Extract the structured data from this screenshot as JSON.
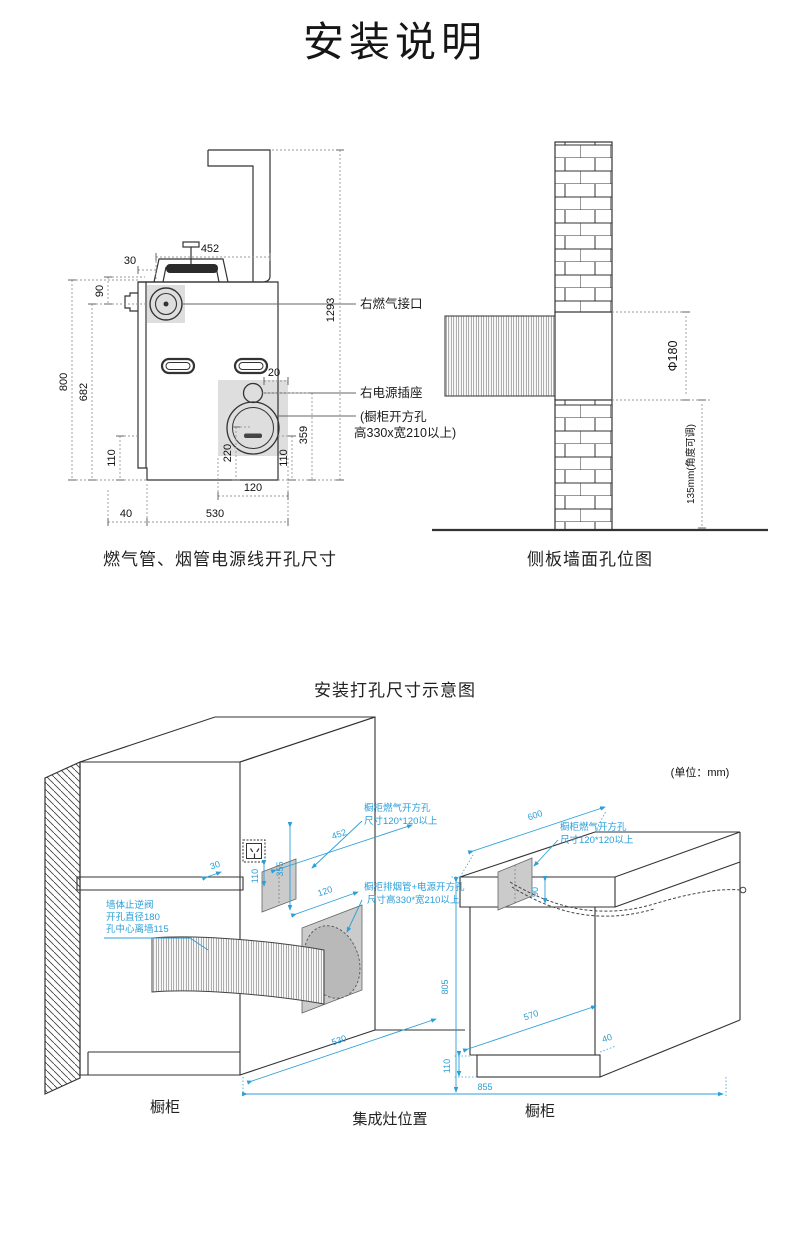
{
  "page": {
    "title": "安装说明"
  },
  "fig1": {
    "caption": "燃气管、烟管电源线开孔尺寸",
    "label_gas": "右燃气接口",
    "label_power": "右电源插座",
    "label_opening1": "(橱柜开方孔",
    "label_opening2": "高330x宽210以上)",
    "dim_452": "452",
    "dim_30": "30",
    "dim_90": "90",
    "dim_1293": "1293",
    "dim_800": "800",
    "dim_682": "682",
    "dim_110_left": "110",
    "dim_220": "220",
    "dim_110_right": "110",
    "dim_359": "359",
    "dim_20": "20",
    "dim_120": "120",
    "dim_40": "40",
    "dim_530": "530"
  },
  "fig2": {
    "caption": "侧板墙面孔位图",
    "dim_diameter": "Φ180",
    "dim_height": "135mm(角度可调)"
  },
  "fig3": {
    "title": "安装打孔尺寸示意图",
    "unit_note": "(单位：mm)",
    "callout_wall_1": "墙体止逆阀",
    "callout_wall_2": "开孔直径180",
    "callout_wall_3": "孔中心离墙115",
    "callout_gas_left_1": "橱柜燃气开方孔",
    "callout_gas_left_2": "尺寸120*120以上",
    "callout_exhaust_1": "橱柜排烟管+电源开方孔",
    "callout_exhaust_2": "尺寸高330*宽210以上",
    "callout_gas_right_1": "橱柜燃气开方孔",
    "callout_gas_right_2": "尺寸120*120以上",
    "dim_30": "30",
    "dim_110_socket": "110",
    "dim_355": "355",
    "dim_452": "452",
    "dim_120": "120",
    "dim_600": "600",
    "dim_90": "90",
    "dim_530": "530",
    "dim_805": "805",
    "dim_855": "855",
    "dim_110_plinth": "110",
    "dim_570": "570",
    "dim_40": "40",
    "label_cabinet_left": "橱柜",
    "label_stove": "集成灶位置",
    "label_cabinet_right": "橱柜"
  }
}
